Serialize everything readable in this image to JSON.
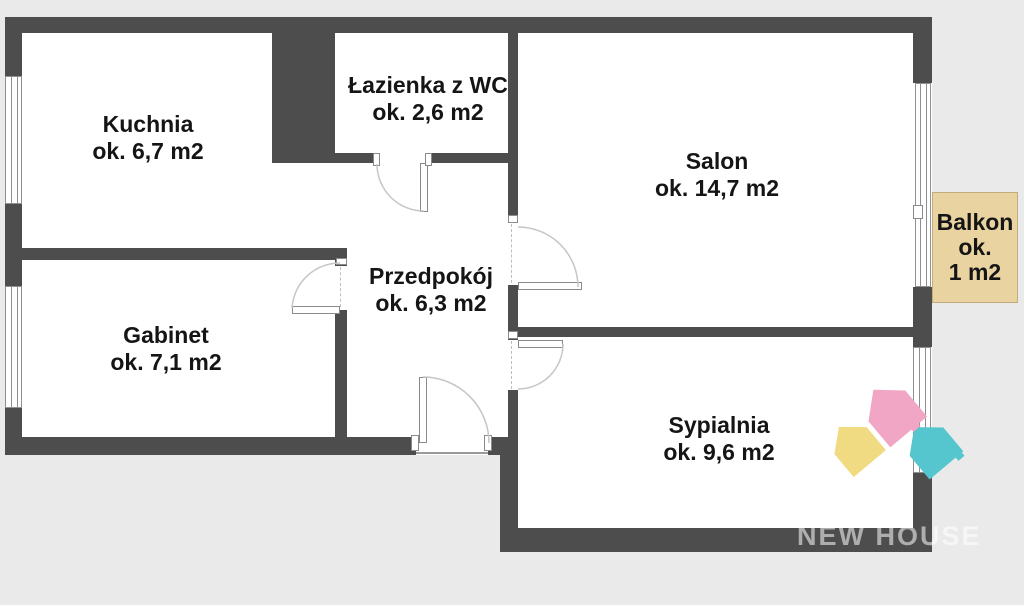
{
  "plan": {
    "rooms": [
      {
        "name": "Kuchnia",
        "area": "ok. 6,7 m2"
      },
      {
        "name": "Łazienka z WC",
        "area": "ok. 2,6 m2"
      },
      {
        "name": "Salon",
        "area": "ok. 14,7 m2"
      },
      {
        "name": "Przedpokój",
        "area": "ok. 6,3 m2"
      },
      {
        "name": "Gabinet",
        "area": "ok. 7,1 m2"
      },
      {
        "name": "Sypialnia",
        "area": "ok. 9,6 m2"
      }
    ],
    "balcony": {
      "name": "Balkon",
      "line2": "ok.",
      "line3": "1 m2"
    },
    "watermark": "NEW HOUSE",
    "colors": {
      "wall": "#4d4d4d",
      "background": "#eaeaea",
      "floor": "#ffffff",
      "balcony_fill": "#e8d3a1",
      "logo_yellow": "#f0db83",
      "logo_pink": "#f2a6c6",
      "logo_teal": "#55c6cd"
    }
  }
}
